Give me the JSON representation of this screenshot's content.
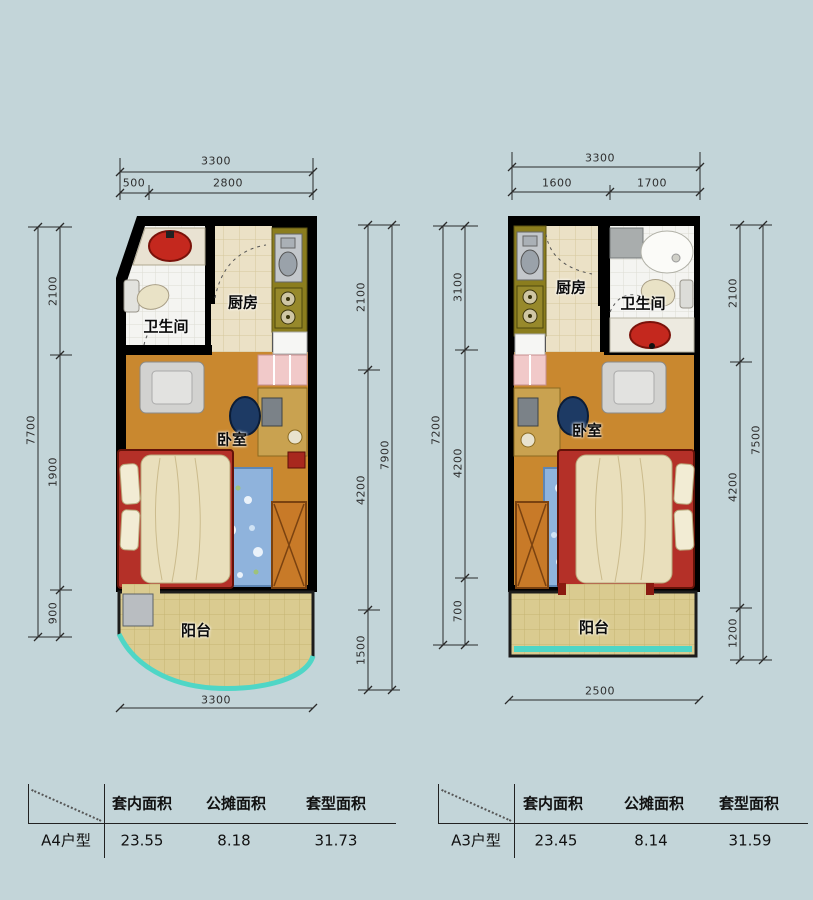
{
  "background": "#c3d5d9",
  "colors": {
    "wall": "#000000",
    "bedroom_floor": "#c9882f",
    "kitchen_floor": "#ebe1c6",
    "bathroom_floor": "#f4f4f1",
    "balcony_floor": "#dacb90",
    "balcony_trim": "#4fd6c6",
    "counter_olive": "#8b7d1e",
    "sink_red": "#c4281e",
    "rug_blue": "#8fb3dc"
  },
  "plans": [
    {
      "id": "A4",
      "rooms": {
        "bathroom": "卫生间",
        "kitchen": "厨房",
        "bedroom": "卧室",
        "balcony": "阳台"
      },
      "dims": {
        "top_total": "3300",
        "top_seg_1": "500",
        "top_seg_2": "2800",
        "left_outer": "7700",
        "left_seg_1": "2100",
        "left_seg_2": "1900",
        "left_seg_3": "900",
        "right_outer": "7900",
        "right_seg_1": "2100",
        "right_seg_2": "4200",
        "right_seg_3": "1500",
        "bottom_total": "3300"
      },
      "table": {
        "unit": "A4户型",
        "col_1": "套内面积",
        "col_2": "公摊面积",
        "col_3": "套型面积",
        "val_1": "23.55",
        "val_2": "8.18",
        "val_3": "31.73"
      }
    },
    {
      "id": "A3",
      "rooms": {
        "kitchen": "厨房",
        "bathroom": "卫生间",
        "bedroom": "卧室",
        "balcony": "阳台"
      },
      "dims": {
        "top_total": "3300",
        "top_seg_1": "1600",
        "top_seg_2": "1700",
        "left_outer": "7200",
        "left_seg_1": "3100",
        "left_seg_2": "4200",
        "left_seg_3": "700",
        "right_outer": "7500",
        "right_seg_1": "2100",
        "right_seg_2": "4200",
        "right_seg_3": "1200",
        "bottom_total": "2500"
      },
      "table": {
        "unit": "A3户型",
        "col_1": "套内面积",
        "col_2": "公摊面积",
        "col_3": "套型面积",
        "val_1": "23.45",
        "val_2": "8.14",
        "val_3": "31.59"
      }
    }
  ]
}
